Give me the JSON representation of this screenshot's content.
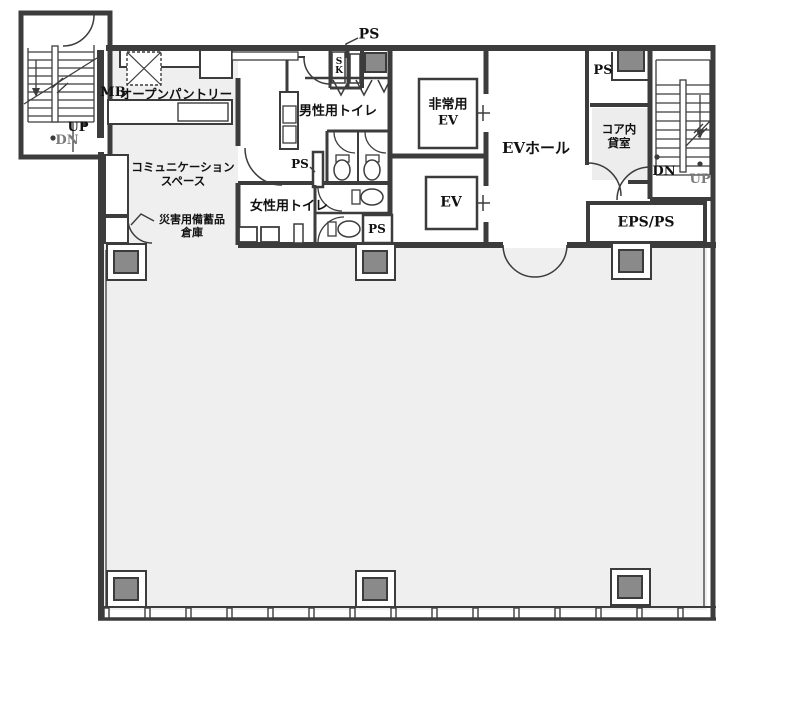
{
  "floor_plan": {
    "labels": {
      "ps_top": "PS",
      "sk_closet": "SK",
      "mailbox": "MB",
      "open_pantry": "オープンパントリー",
      "mens_toilet": "男性用トイレ",
      "emergency_elevator": {
        "line1": "非常用",
        "line2": "EV"
      },
      "elevator": "EV",
      "ev_hall": "EVホール",
      "ps_top_right": "PS",
      "core_rental_room": {
        "line1": "コア内",
        "line2": "貸室"
      },
      "stair_right": {
        "dn": "DN",
        "up": "UP"
      },
      "stair_left": {
        "up": "UP",
        "dn": "DN"
      },
      "communication_space": {
        "line1": "コミュニケーション",
        "line2": "スペース"
      },
      "disaster_storage": {
        "line1": "災害用備蓄品",
        "line2": "倉庫"
      },
      "womens_toilet": "女性用トイレ",
      "ps_mid": "PS",
      "ps_bottom": "PS",
      "eps_ps": "EPS/PS"
    },
    "colors": {
      "wall": "#3c3c3c",
      "tenant_floor": "#efefef",
      "core_floor": "#ffffff",
      "column_fill": "#8a8a8a"
    }
  }
}
